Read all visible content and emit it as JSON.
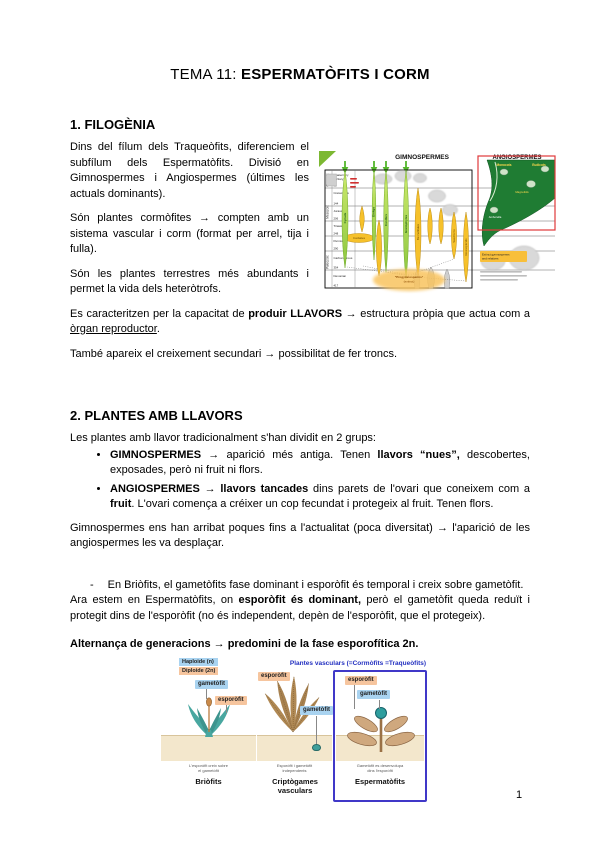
{
  "page_number": "1",
  "title": {
    "prefix": "TEMA 11: ",
    "main": "ESPERMATÒFITS I CORM"
  },
  "section1": {
    "heading": "1. FILOGÈNIA",
    "p1": "Dins del fílum dels Traqueòfits, diferenciem el subfílum dels Espermatòfits. Divisió en Gimnospermes i Angiospermes (últimes les actuals dominants).",
    "p2": "Són plantes cormòfites → compten amb un sistema vascular i corm (format per arrel, tija i fulla).",
    "p3": "Són les plantes terrestres més abundants i permet la vida dels heteròtrofs.",
    "p4_a": "Es caracteritzen per la capacitat de ",
    "p4_b": "produir LLAVORS",
    "p4_c": " → estructura pròpia que actua com a ",
    "p4_d": "òrgan reproductor",
    "p4_e": ".",
    "p5": "També apareix el creixement secundari → possibilitat de fer troncs."
  },
  "chart": {
    "header_gimnospermes": "GIMNOSPERMES",
    "header_angiospermes": "ANGIOSPERMES",
    "eras": [
      "Cenozoic",
      "Mesozoic",
      "Paleozoic"
    ],
    "periods": [
      {
        "line1": "Quaternary",
        "line2": "Tertiary",
        "mya": "65"
      },
      {
        "line1": "Cretaceous",
        "line2": "",
        "mya": "144"
      },
      {
        "line1": "Jurassic",
        "line2": "",
        "mya": "206"
      },
      {
        "line1": "Triassic",
        "line2": "",
        "mya": "248"
      },
      {
        "line1": "Permian",
        "line2": "",
        "mya": "290"
      },
      {
        "line1": "Carboniferous",
        "line2": "",
        "mya": "354"
      },
      {
        "line1": "Devonian",
        "line2": "",
        "mya": "417"
      }
    ],
    "living_groups": [
      "Cycads",
      "Ginkgo",
      "Conifers",
      "Gnetophytes"
    ],
    "extinct_groups": [
      "Cordaites",
      "Bennettitales",
      "Seed ferns",
      "Glossopterids"
    ],
    "angiosperm_labels": {
      "monocots": "Monocots",
      "eudicots": "Eudicots",
      "amborella": "Amborella",
      "magnoliids": "Magnoliids"
    },
    "extinct_note_line1": "Extinct gymnosperms",
    "extinct_note_line2": "and relatives",
    "ancestor_line1": "“Progymnosperms”",
    "ancestor_line2": "(extinct)"
  },
  "section2": {
    "heading": "2. PLANTES AMB LLAVORS",
    "intro": "Les plantes amb llavor tradicionalment s'han dividit en 2 grups:",
    "b1_a": "GIMNOSPERMES",
    "b1_b": " → aparició més antiga. Tenen ",
    "b1_c": "llavors “nues”,",
    "b1_d": " descobertes, exposades, però ni fruit ni flors.",
    "b2_a": "ANGIOSPERMES",
    "b2_b": " → ",
    "b2_c": "llavors tancades",
    "b2_d": " dins parets de l'ovari que coneixem com a ",
    "b2_e": "fruit",
    "b2_f": ". L'ovari comença a créixer un cop fecundat i protegeix al fruit. Tenen flors.",
    "p2": "Gimnospermes ens han arribat poques fins a l'actualitat (poca diversitat) → l'aparició de les angiospermes les va desplaçar.",
    "dash": "-",
    "dash_text": "En Briòfits, el gametòfits fase dominant i esporòfit és temporal i creix sobre gametòfit.",
    "p3_a": "Ara estem en Espermatòfits, on ",
    "p3_b": "esporòfit és dominant,",
    "p3_c": " però el gametòfit queda reduït i protegit dins de l'esporòfit (no és independent, depèn de l'esporòfit, que el protegeix).",
    "alternanca": "Alternança de generacions → predomini de la fase esporofítica 2n."
  },
  "figure": {
    "legend_haploide": "Haploide (n)",
    "legend_diploide": "Diploide (2n)",
    "title": "Plantes vasculars (=Cormòfits =Traqueòfits)",
    "panels": [
      {
        "caption": "Briòfits",
        "note1": "L'esporòfit creix sobre",
        "note2": "el gametòfit",
        "label_top": "gametòfit",
        "label_bottom": "esporòfit"
      },
      {
        "caption": "Criptògames vasculars",
        "note1": "Esporòfit i gametòfit",
        "note2": "independents",
        "label_top": "esporòfit",
        "label_bottom": "gametòfit"
      },
      {
        "caption": "Espermatòfits",
        "note1": "Gametòfit es desenvolupa",
        "note2": "dins l'esporòfit",
        "label_top": "esporòfit",
        "label_bottom": "gametòfit"
      }
    ]
  }
}
